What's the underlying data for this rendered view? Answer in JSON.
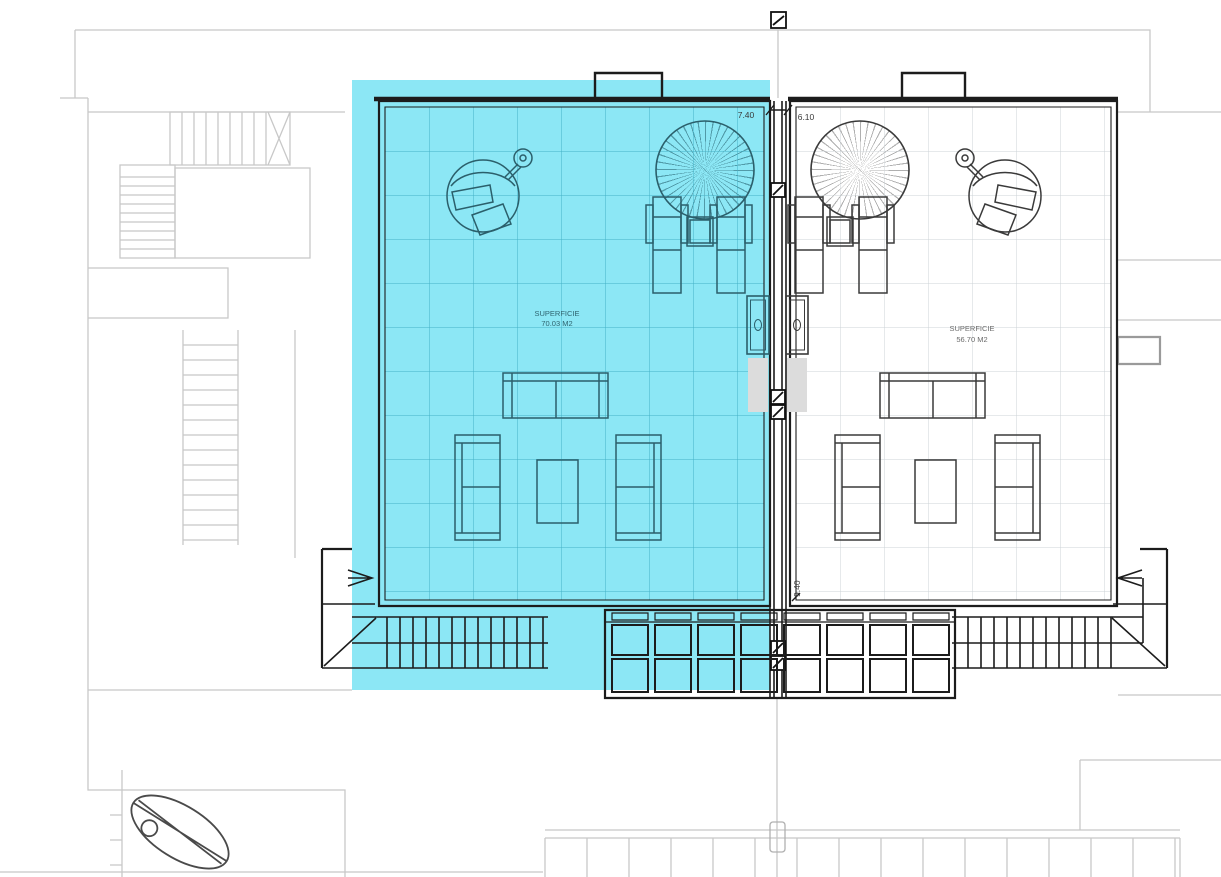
{
  "plan": {
    "units": {
      "left": {
        "area_label": "SUPERFICIE",
        "area_value": "70.03 M2",
        "width_dim": "7.40",
        "selected": true
      },
      "right": {
        "area_label": "SUPERFICIE",
        "area_value": "56.70 M2",
        "width_dim": "6.10",
        "depth_dim": "9.40",
        "selected": false
      }
    },
    "colors": {
      "highlight": "#8CE7F5",
      "ink": "#1c1c1c",
      "context": "#c8c8c8",
      "left_ink": "#2b5f6b"
    }
  }
}
